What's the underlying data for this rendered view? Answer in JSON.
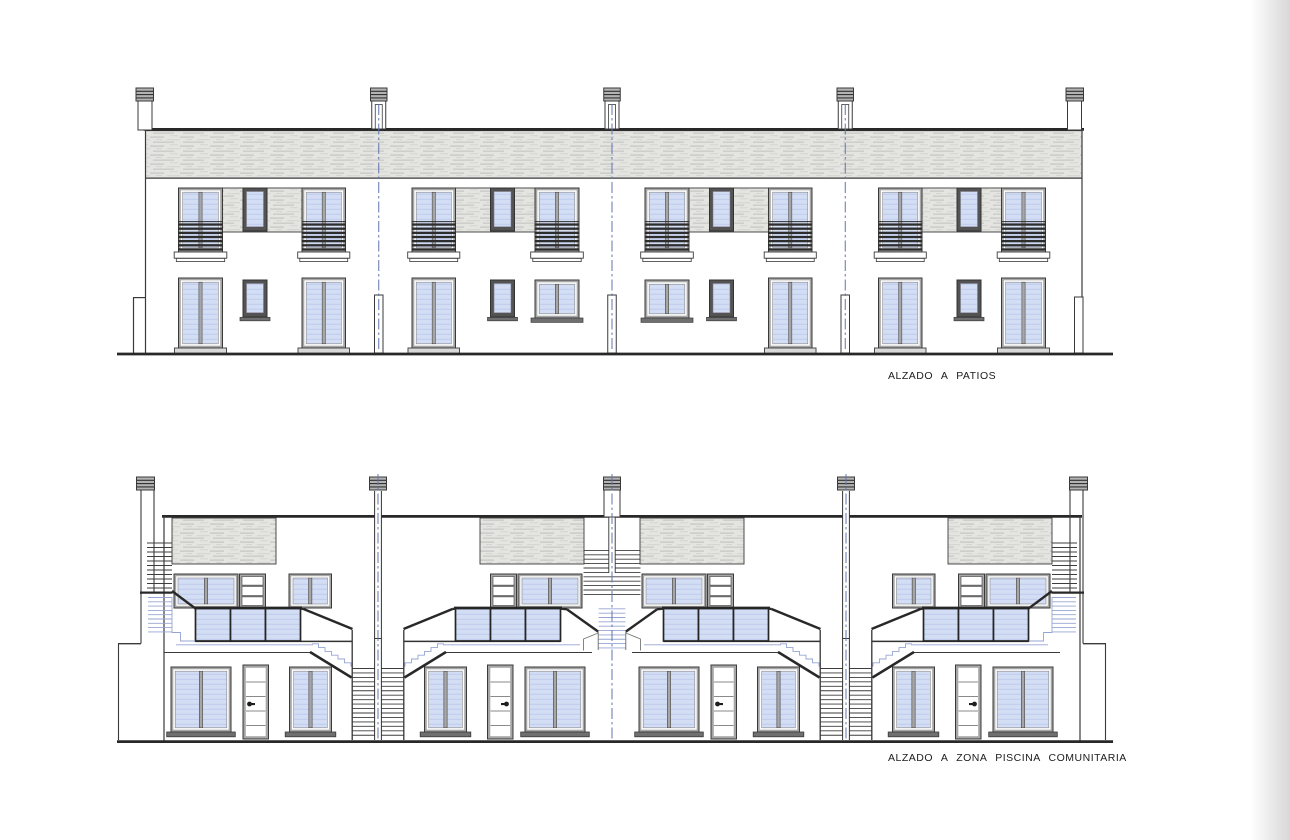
{
  "page": {
    "background": "#ffffff",
    "edge_shadow": "#d8d8d8"
  },
  "colors": {
    "line": "#3a3a3a",
    "line_dark": "#282828",
    "frame": "#a6a6a6",
    "frame_dark": "#535353",
    "glass": "#d3ddf4",
    "glass_stripe": "#bdccec",
    "glass_frame": "#262626",
    "hatch_bg": "#e4e4e1",
    "hatch_streak": "#c2c2c0",
    "hatch_streak2": "#d2d2cf",
    "louver": "#2d2d2d",
    "axis_dash": "#6274ae",
    "stair_light": "#96a5d4",
    "sill": "#6f6f6f",
    "threshold": "#d9d9d9",
    "cap_fill": "#b3b3b3"
  },
  "elevations": [
    {
      "id": "patios",
      "label": "ALZADO A PATIOS",
      "units": 4,
      "floors": 2,
      "party_axes": 3,
      "chimneys": 5
    },
    {
      "id": "piscina",
      "label": "ALZADO A ZONA PISCINA COMUNITARIA",
      "units": 4,
      "floors": 2,
      "party_axes": 3,
      "chimneys": 5
    }
  ]
}
